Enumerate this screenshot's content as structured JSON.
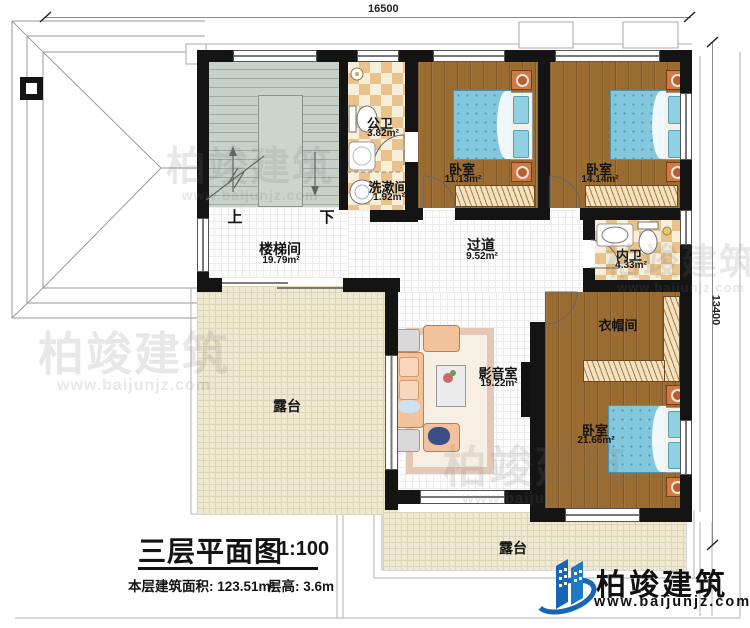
{
  "dimensions": {
    "top": "16500",
    "right": "13400"
  },
  "stairs": {
    "up": "上",
    "down": "下"
  },
  "rooms": {
    "public_bath": {
      "name": "公卫",
      "area": "3.82m²"
    },
    "wash_room": {
      "name": "洗漱间",
      "area": "1.92m²"
    },
    "bedroom1": {
      "name": "卧室",
      "area": "11.13m²"
    },
    "bedroom2": {
      "name": "卧室",
      "area": "14.14m²"
    },
    "inner_bath": {
      "name": "内卫",
      "area": "4.33m²"
    },
    "stair_hall": {
      "name": "楼梯间",
      "area": "19.79m²"
    },
    "corridor": {
      "name": "过道",
      "area": "9.52m²"
    },
    "cloak_room": {
      "name": "衣帽间"
    },
    "media_room": {
      "name": "影音室",
      "area": "19.22m²"
    },
    "bedroom3": {
      "name": "卧室",
      "area": "21.66m²"
    },
    "terrace_left": {
      "name": "露台"
    },
    "terrace_bottom": {
      "name": "露台"
    }
  },
  "title": {
    "name": "三层平面图",
    "scale": "1:100",
    "area_label": "本层建筑面积: 123.51m²",
    "floor_height": "层高: 3.6m"
  },
  "brand": {
    "name": "柏竣建筑",
    "url": "www.baijunjz.com"
  },
  "watermark": {
    "name": "柏竣建筑",
    "url": "www.baijunjz.com"
  },
  "colors": {
    "wall": "#141414",
    "wood_floor": "#9a6c32",
    "bath_tile": "#e9c28c",
    "terrace": "#efe9d2",
    "stair": "#c7d1c8",
    "bed": "#82c7db",
    "brand_blue": "#1766b5"
  }
}
